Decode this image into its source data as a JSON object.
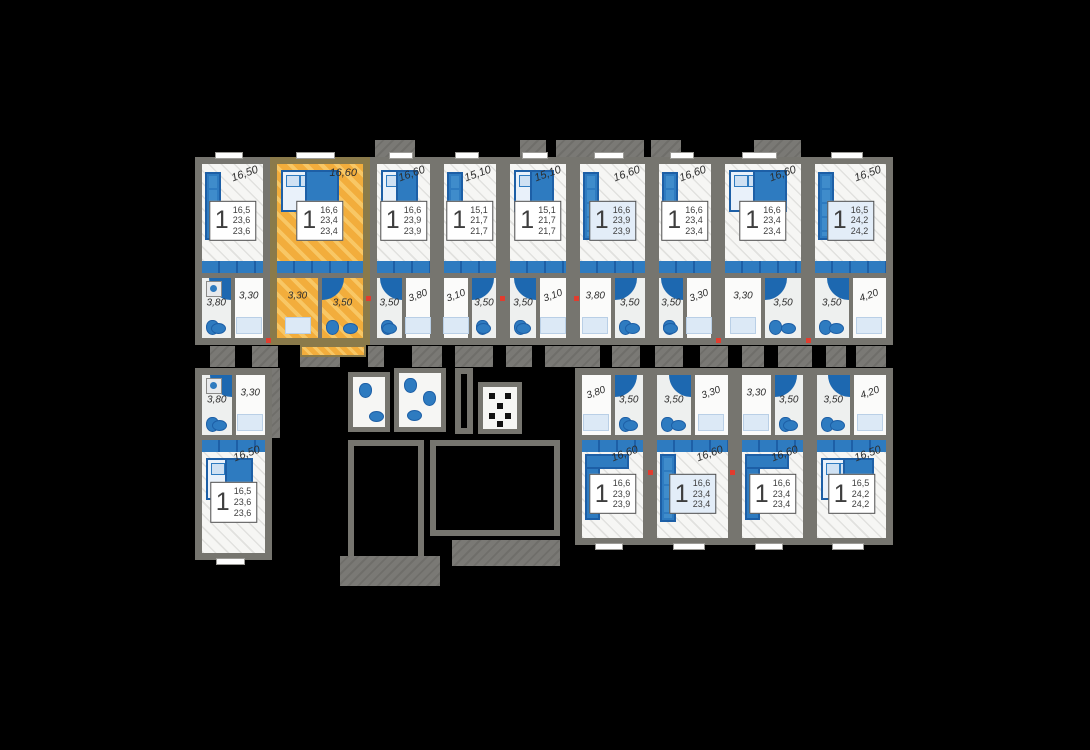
{
  "plan": {
    "kind": "residential-floor-plan",
    "colors": {
      "background": "#000000",
      "walls": "#76756f",
      "floor": "#f6f6f4",
      "furniture_blue": "#2e7bc0",
      "furniture_blue_dark": "#1d5fa6",
      "furniture_blue_pale": "#dce9f6",
      "highlight_yellow": "#f2ad3c",
      "accent_red": "#e23c2e",
      "info_text": "#3e3e3e"
    },
    "top_row_units": [
      {
        "rooms": "1",
        "areas": [
          "16,5",
          "23,6",
          "23,6"
        ],
        "room_area_label": "16,50",
        "bath_area_label": "3,80",
        "hall_area_label": "3,30",
        "highlighted": false,
        "furniture": "sofa"
      },
      {
        "rooms": "1",
        "areas": [
          "16,6",
          "23,4",
          "23,4"
        ],
        "room_area_label": "16,60",
        "bath_area_label": "3,50",
        "hall_area_label": "3,30",
        "highlighted": true,
        "furniture": "bed"
      },
      {
        "rooms": "1",
        "areas": [
          "16,6",
          "23,9",
          "23,9"
        ],
        "room_area_label": "16,60",
        "bath_area_label": "3,50",
        "hall_area_label": "3,80",
        "highlighted": false,
        "furniture": "bed"
      },
      {
        "rooms": "1",
        "areas": [
          "15,1",
          "21,7",
          "21,7"
        ],
        "room_area_label": "15,10",
        "bath_area_label": "3,50",
        "hall_area_label": "3,10",
        "highlighted": false,
        "furniture": "sofa"
      },
      {
        "rooms": "1",
        "areas": [
          "15,1",
          "21,7",
          "21,7"
        ],
        "room_area_label": "15,10",
        "bath_area_label": "3,50",
        "hall_area_label": "3,10",
        "highlighted": false,
        "furniture": "bed"
      },
      {
        "rooms": "1",
        "areas": [
          "16,6",
          "23,9",
          "23,9"
        ],
        "room_area_label": "16,60",
        "bath_area_label": "3,50",
        "hall_area_label": "3,80",
        "highlighted": false,
        "furniture": "sofa"
      },
      {
        "rooms": "1",
        "areas": [
          "16,6",
          "23,4",
          "23,4"
        ],
        "room_area_label": "16,60",
        "bath_area_label": "3,50",
        "hall_area_label": "3,30",
        "highlighted": false,
        "furniture": "sofa"
      },
      {
        "rooms": "1",
        "areas": [
          "16,6",
          "23,4",
          "23,4"
        ],
        "room_area_label": "16,60",
        "bath_area_label": "3,50",
        "hall_area_label": "3,30",
        "highlighted": false,
        "furniture": "bed"
      },
      {
        "rooms": "1",
        "areas": [
          "16,5",
          "24,2",
          "24,2"
        ],
        "room_area_label": "16,50",
        "bath_area_label": "3,50",
        "hall_area_label": "4,20",
        "highlighted": false,
        "furniture": "sofa"
      }
    ],
    "bottom_row_units": [
      {
        "rooms": "1",
        "areas": [
          "16,5",
          "23,6",
          "23,6"
        ],
        "room_area_label": "16,50",
        "bath_area_label": "3,80",
        "hall_area_label": "3,30",
        "highlighted": false,
        "furniture": "bed"
      },
      {
        "rooms": "1",
        "areas": [
          "16,6",
          "23,9",
          "23,9"
        ],
        "room_area_label": "16,60",
        "bath_area_label": "3,50",
        "hall_area_label": "3,80",
        "highlighted": false,
        "furniture": "corner-sofa"
      },
      {
        "rooms": "1",
        "areas": [
          "16,6",
          "23,4",
          "23,4"
        ],
        "room_area_label": "16,60",
        "bath_area_label": "3,50",
        "hall_area_label": "3,30",
        "highlighted": false,
        "furniture": "sofa"
      },
      {
        "rooms": "1",
        "areas": [
          "16,6",
          "23,4",
          "23,4"
        ],
        "room_area_label": "16,60",
        "bath_area_label": "3,50",
        "hall_area_label": "3,30",
        "highlighted": false,
        "furniture": "corner-sofa"
      },
      {
        "rooms": "1",
        "areas": [
          "16,5",
          "24,2",
          "24,2"
        ],
        "room_area_label": "16,50",
        "bath_area_label": "3,50",
        "hall_area_label": "4,20",
        "highlighted": false,
        "furniture": "bed"
      }
    ]
  }
}
